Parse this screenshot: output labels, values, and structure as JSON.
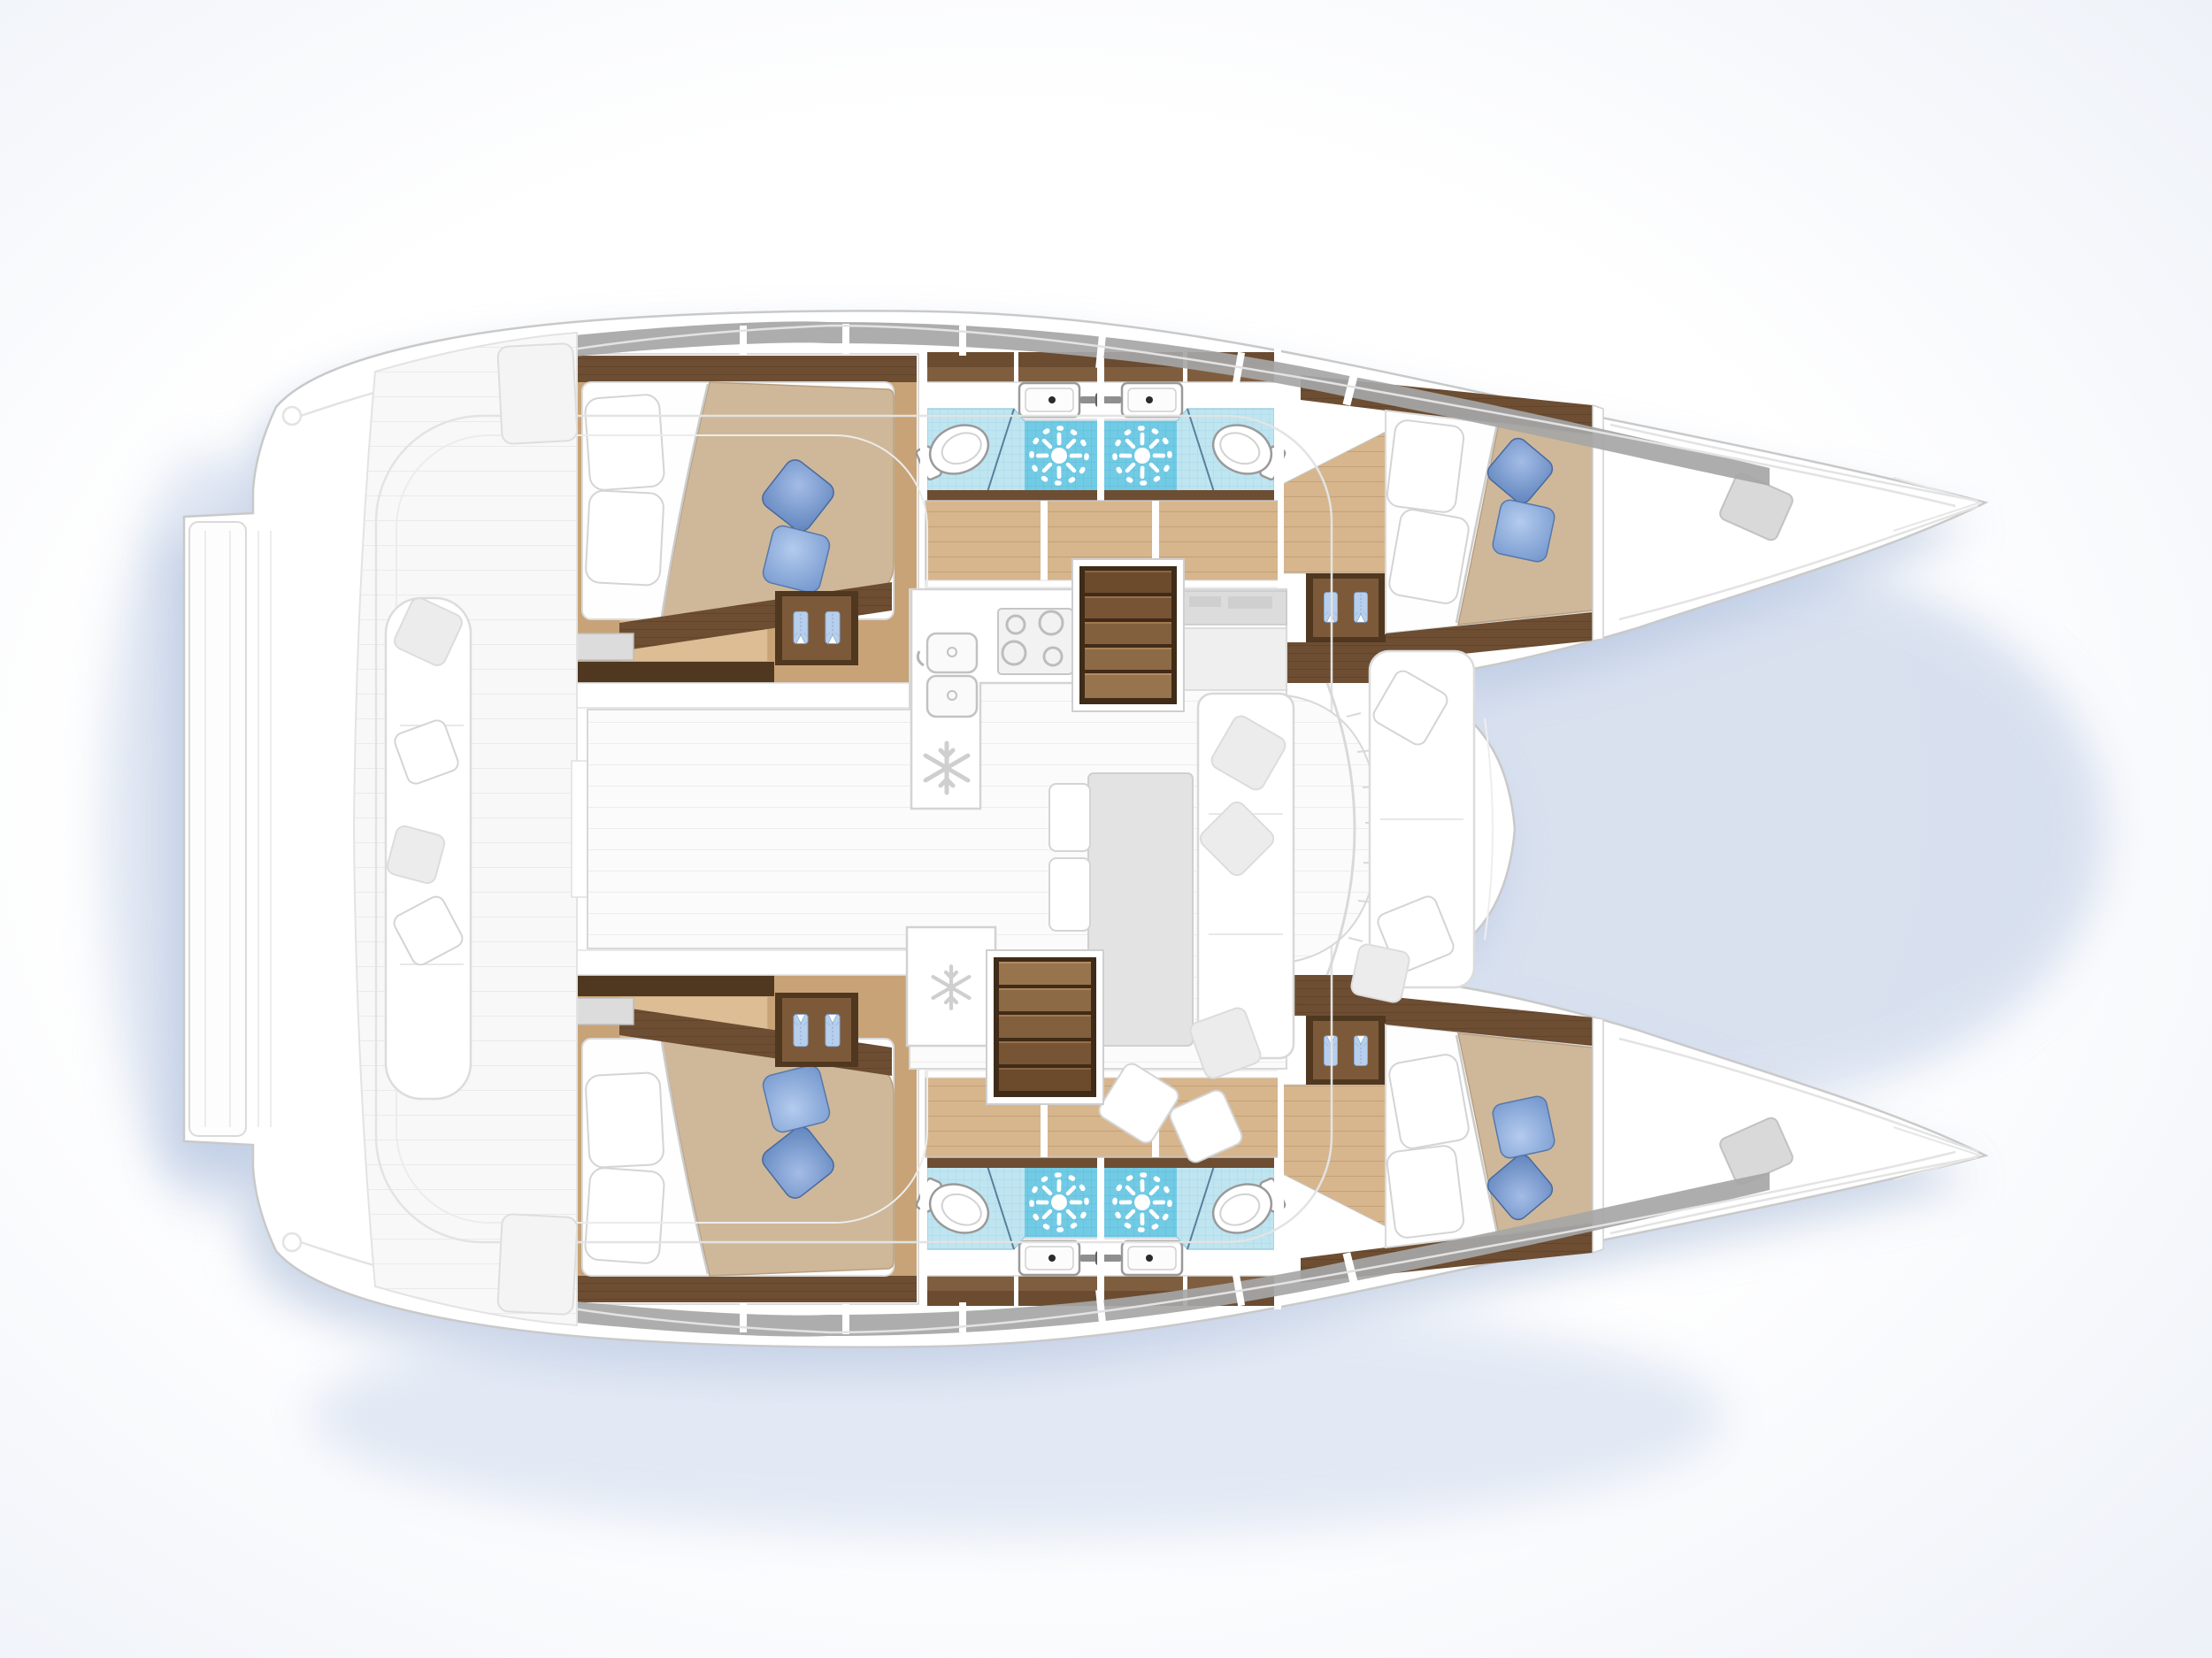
{
  "document": {
    "kind": "boat-floor-plan",
    "vessel_type": "sailing catamaran",
    "view": "top-down accommodation and deck plan, bow pointing right",
    "layout_name": "4 cabins / 4 heads version",
    "visible_text": []
  },
  "palette": {
    "page_bg": "#ffffff",
    "shadow_blue": "#9fb3d4",
    "outline_gray": "#c9c9c9",
    "faded_line": "#e3e3e3",
    "window_band": "#a6a6a6",
    "wood_dark": "#6d4e33",
    "wood_darker": "#50371f",
    "wood_mid": "#c8a377",
    "wood_light": "#d7b68e",
    "plank_line": "#bd9a6e",
    "duvet_beige": "#cfb899",
    "bedding_white": "#fefefe",
    "pillow_blue_1": "#6288c1",
    "pillow_blue_2": "#7296cd",
    "shirt_blue": "#b7cfec",
    "tile_light": "#bfe5f1",
    "tile_light_grid": "#a9d8e8",
    "tile_dark": "#72cbe5",
    "tile_dark_grid": "#5cbcd8",
    "fixture_outline": "#9a9a9a",
    "faded_fill": "#f4f4f4",
    "salon_plank": "#ededed"
  },
  "counts": {
    "cabins": 4,
    "heads": 4,
    "showers": 4,
    "double_berths": 4
  },
  "areas": {
    "port_hull": {
      "aft_cabin": {
        "label": "port aft double cabin",
        "features": [
          "island double berth",
          "two white pillows",
          "two blue accent pillows",
          "beige duvet turned back",
          "wardrobe with two hanging shirts",
          "storage step",
          "deck hatch"
        ]
      },
      "aft_head": {
        "label": "port aft bathroom",
        "features": [
          "washbasin with mixer tap",
          "marine toilet",
          "shower area with drain rose",
          "light blue mosaic floor",
          "overhead lockers"
        ]
      },
      "fwd_head": {
        "label": "port forward bathroom",
        "features": [
          "washbasin with mixer tap",
          "marine toilet",
          "shower area with drain rose",
          "light blue mosaic floor",
          "overhead lockers"
        ]
      },
      "fwd_cabin": {
        "label": "port forward double cabin",
        "features": [
          "island double berth",
          "two white pillows",
          "two blue accent pillows",
          "beige duvet turned back",
          "wardrobe with two hanging shirts"
        ]
      },
      "corridor": {
        "label": "port hull passageway",
        "features": [
          "teak sole",
          "cabin and head doors"
        ]
      },
      "hull_windows": {
        "label": "hull window strip with mullions"
      },
      "foredeck": {
        "label": "port bow locker deck",
        "features": [
          "anchor locker hatch"
        ]
      }
    },
    "starboard_hull": {
      "aft_cabin": {
        "label": "starboard aft double cabin",
        "features": [
          "island double berth",
          "two white pillows",
          "two blue accent pillows",
          "beige duvet turned back",
          "wardrobe with two hanging shirts",
          "storage step",
          "deck hatch"
        ]
      },
      "aft_head": {
        "label": "starboard aft bathroom",
        "features": [
          "washbasin with mixer tap",
          "marine toilet",
          "shower area with drain rose",
          "light blue mosaic floor",
          "overhead lockers"
        ]
      },
      "fwd_head": {
        "label": "starboard forward bathroom",
        "features": [
          "washbasin with mixer tap",
          "marine toilet",
          "shower area with drain rose",
          "light blue mosaic floor",
          "overhead lockers"
        ]
      },
      "fwd_cabin": {
        "label": "starboard forward double cabin",
        "features": [
          "island double berth",
          "two white pillows",
          "two blue accent pillows",
          "beige duvet turned back",
          "wardrobe with two hanging shirts"
        ]
      },
      "corridor": {
        "label": "starboard hull passageway",
        "features": [
          "teak sole",
          "cabin and head doors"
        ]
      },
      "hull_windows": {
        "label": "hull window strip with mullions"
      },
      "foredeck": {
        "label": "starboard bow locker deck",
        "features": [
          "anchor locker hatch"
        ]
      }
    },
    "bridgedeck": {
      "salon": {
        "label": "saloon (shown faded)",
        "features": [
          "dining table",
          "L-shaped settee",
          "side seats",
          "scatter cushions",
          "curved front windows"
        ]
      },
      "galley": {
        "label": "galley (shown faded)",
        "features": [
          "four-burner hob",
          "double sink with faucet",
          "refrigerator",
          "freezer"
        ]
      },
      "nav_station": {
        "label": "chart table / nav station (shown faded)",
        "features": [
          "instrument panel",
          "desk"
        ]
      },
      "companionway_port": {
        "label": "steps from saloon down to port hull",
        "steps": 5
      },
      "companionway_starboard": {
        "label": "steps from saloon down to starboard hull",
        "steps": 5
      },
      "fwd_cockpit": {
        "label": "forward cockpit bench (shown faded)",
        "features": [
          "cushioned bench",
          "scatter pillows"
        ]
      },
      "aft_cockpit": {
        "label": "aft cockpit (shown faded)",
        "features": [
          "full-height bench seat with pillows",
          "teak deck",
          "hardtop outline"
        ]
      },
      "transom": {
        "label": "aft crossbeam and transom steps (shown faded)"
      }
    },
    "icon_legend": {
      "sunburst": "shower-drain-icon",
      "snowflake": "refrigeration-icon",
      "hanging_shirts": "wardrobe-icon",
      "four_circles": "stove-burners-icon",
      "oval_with_tank": "toilet-icon",
      "rounded_basin": "sink-icon"
    }
  }
}
